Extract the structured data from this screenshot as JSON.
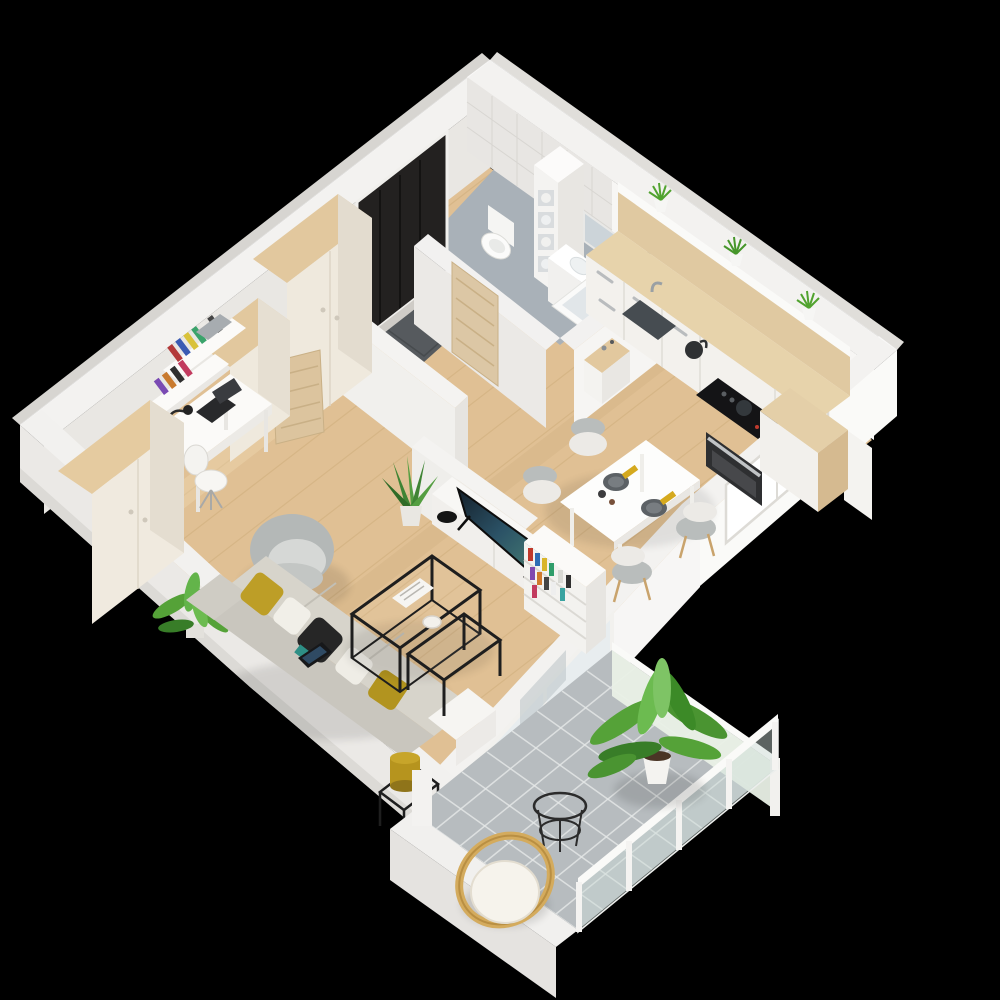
{
  "scene": {
    "type": "3d-floor-plan-render",
    "view": "isometric dollhouse cutaway of a one-bedroom apartment with balcony",
    "background": "#000000"
  },
  "palette": {
    "background": "#000000",
    "wall_top": "#f3f2f0",
    "wall_face": "#e9e7e3",
    "wall_outer": "#d7d5d1",
    "wall_bright": "#fafaf8",
    "wood_floor": "#e0c094",
    "wood_floor_light": "#ecd4ad",
    "bathroom_floor": "#a9b1b8",
    "balcony_tile": "#b7bcbf",
    "grout": "#e6e8e8",
    "cabinet_wood": "#e2c89e",
    "counter_wood": "#e7d3ab",
    "cream_front": "#efe9dd",
    "white_furniture": "#f6f5f2",
    "sofa_gray": "#d7d4cb",
    "mustard": "#bd9e27",
    "black_metal": "#1f1f1f",
    "plant_green": "#55a238",
    "plant_dark": "#3c8a27",
    "tv_screen": "#2b4456",
    "rattan": "#d4ab5d",
    "appliance_black": "#141416",
    "door_wood": "#dcc7a5",
    "entry_dark": "#232120",
    "mat_gray": "#565a5e",
    "glass": "#e8edef"
  },
  "rooms": [
    {
      "name": "hallway",
      "floor": "wood planks",
      "items": [
        "entry-door-recess",
        "gray-doormat",
        "shoes",
        "open-room-door",
        "console-table-with-perfumes"
      ]
    },
    {
      "name": "bathroom",
      "floor": "gray tile",
      "items": [
        "toilet",
        "shelf-tower-with-towels",
        "vanity-sink",
        "mirror",
        "bathtub",
        "shower-fixture",
        "wood-door"
      ]
    },
    {
      "name": "kitchen",
      "floor": "wood planks",
      "items": [
        "white-base-cabinets",
        "wood-countertop",
        "sink",
        "faucet",
        "kettle",
        "cooktop",
        "oven",
        "grass-plant-1",
        "grass-plant-2",
        "grass-plant-3",
        "wood-counter-block",
        "tall-cabinet"
      ]
    },
    {
      "name": "dining-area",
      "floor": "wood planks",
      "items": [
        "white-table",
        "chair-1",
        "chair-2",
        "chair-3",
        "chair-4",
        "plate-1",
        "plate-2",
        "yellow-napkins",
        "window"
      ]
    },
    {
      "name": "living-room",
      "floor": "wood planks",
      "items": [
        "sofa",
        "mustard-cushions",
        "white-cushions",
        "black-cushion",
        "tablet",
        "nesting-coffee-table-large",
        "nesting-coffee-table-small",
        "magazines",
        "white-bowl",
        "side-table-with-mustard-lamp",
        "tv-stand",
        "tv",
        "black-bowl",
        "bookshelf-with-books",
        "aloe-plant",
        "palm-plant",
        "gray-armchair",
        "desk",
        "desk-lamp",
        "laptop",
        "desk-chair",
        "wall-shelves-with-books",
        "wardrobe-1",
        "wardrobe-2",
        "tall-cabinet",
        "sliding-balcony-door"
      ]
    },
    {
      "name": "balcony",
      "floor": "gray tile grid",
      "items": [
        "large-palm-plant",
        "rattan-chair-with-white-cushion",
        "black-wire-side-table",
        "glass-railing-with-white-posts",
        "frosted-glass-wall"
      ]
    }
  ]
}
